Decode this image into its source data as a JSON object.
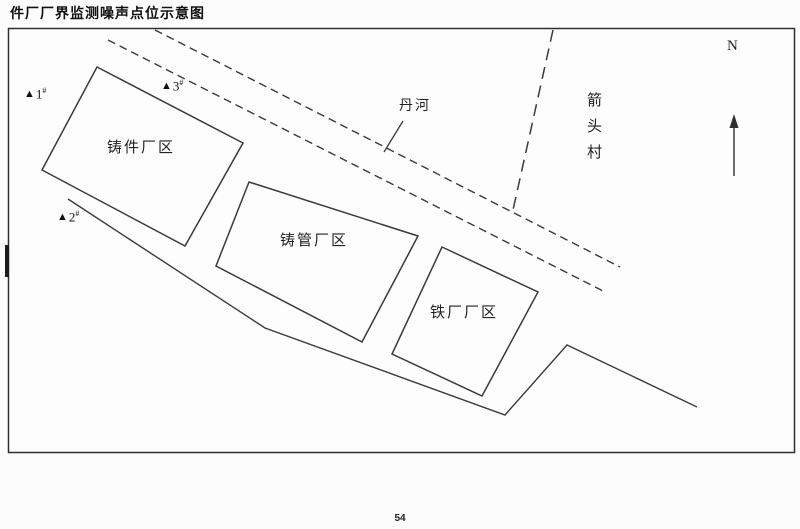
{
  "page": {
    "title": "件厂厂界监测噪声点位示意图",
    "page_number": "54"
  },
  "map": {
    "factories": [
      {
        "label": "铸件厂区"
      },
      {
        "label": "铸管厂区"
      },
      {
        "label": "铁厂厂区"
      }
    ],
    "river_label": "丹河",
    "village_label": "箭头村",
    "north_label": "N",
    "marker_glyph": "▲",
    "marker_suffix": "#",
    "monitoring_points": [
      {
        "number": "1"
      },
      {
        "number": "2"
      },
      {
        "number": "3"
      }
    ],
    "colors": {
      "line": "#3a3a3a",
      "background": "#fcfcfc"
    }
  }
}
